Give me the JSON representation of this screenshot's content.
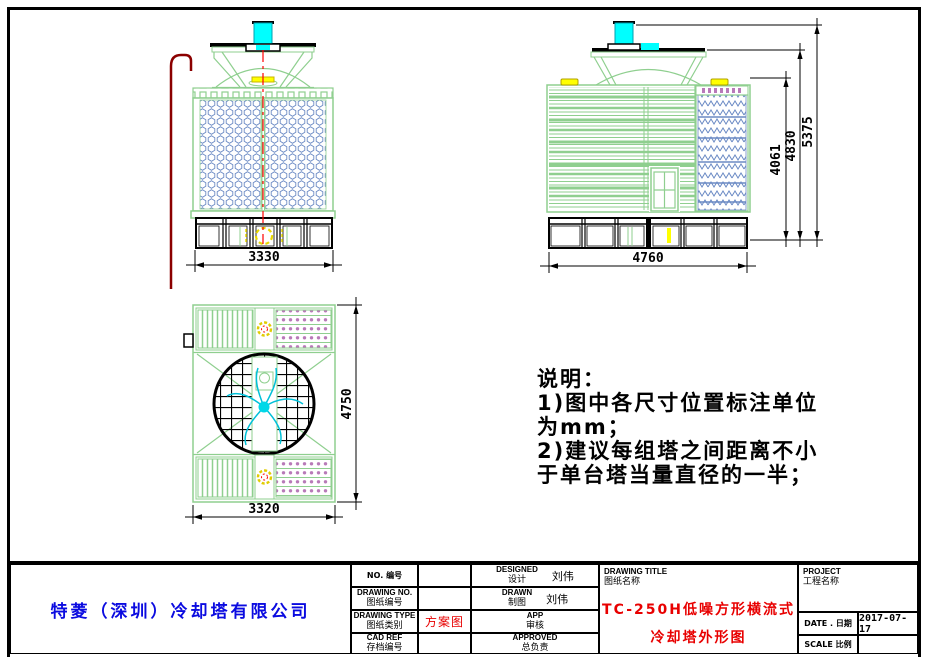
{
  "dimensions": {
    "front_width": "3330",
    "side_width": "4760",
    "side_height_inner": "4061",
    "side_height_casing": "4830",
    "side_height_total": "5375",
    "top_depth": "4750",
    "top_width": "3320"
  },
  "notes": {
    "title": "说明：",
    "lines": [
      "1)图中各尺寸位置标注单位",
      "为mm；",
      "2)建议每组塔之间距离不小",
      "于单台塔当量直径的一半；"
    ]
  },
  "title_block": {
    "company": "特菱（深圳）冷却塔有限公司",
    "no_label": "NO. 编号",
    "drawing_no_en": "DRAWING NO.",
    "drawing_no_cn": "图纸编号",
    "drawing_type_en": "DRAWING TYPE",
    "drawing_type_cn": "图纸类别",
    "drawing_type_value": "方案图",
    "cad_ref_en": "CAD REF",
    "cad_ref_cn": "存档编号",
    "designed_en": "DESIGNED",
    "designed_cn": "设计",
    "designed_value": "刘伟",
    "drawn_en": "DRAWN",
    "drawn_cn": "制图",
    "drawn_value": "刘伟",
    "app_en": "APP",
    "app_cn": "审核",
    "approved_en": "APPROVED",
    "approved_cn": "总负责",
    "drawing_title_en": "DRAWING TITLE",
    "drawing_title_cn": "图纸名称",
    "drawing_title_value_line1": "TC-250H低噪方形横流式",
    "drawing_title_value_line2": "冷却塔外形图",
    "project_en": "PROJECT",
    "project_cn": "工程名称",
    "date_label": "DATE . 日期",
    "date_value": "2017-07-17",
    "scale_label": "SCALE 比例"
  },
  "colors": {
    "outline_green": "#8fcf8f",
    "fill_blue": "#6b8ac4",
    "motor_cyan": "#00ffff",
    "hub_yellow": "#ffff00",
    "centerline_red": "#ff0000",
    "pipe_dark_red": "#8b0000",
    "eliminator_purple": "#b87ab8",
    "company_blue": "#0b0be0",
    "title_red": "#e80000"
  }
}
